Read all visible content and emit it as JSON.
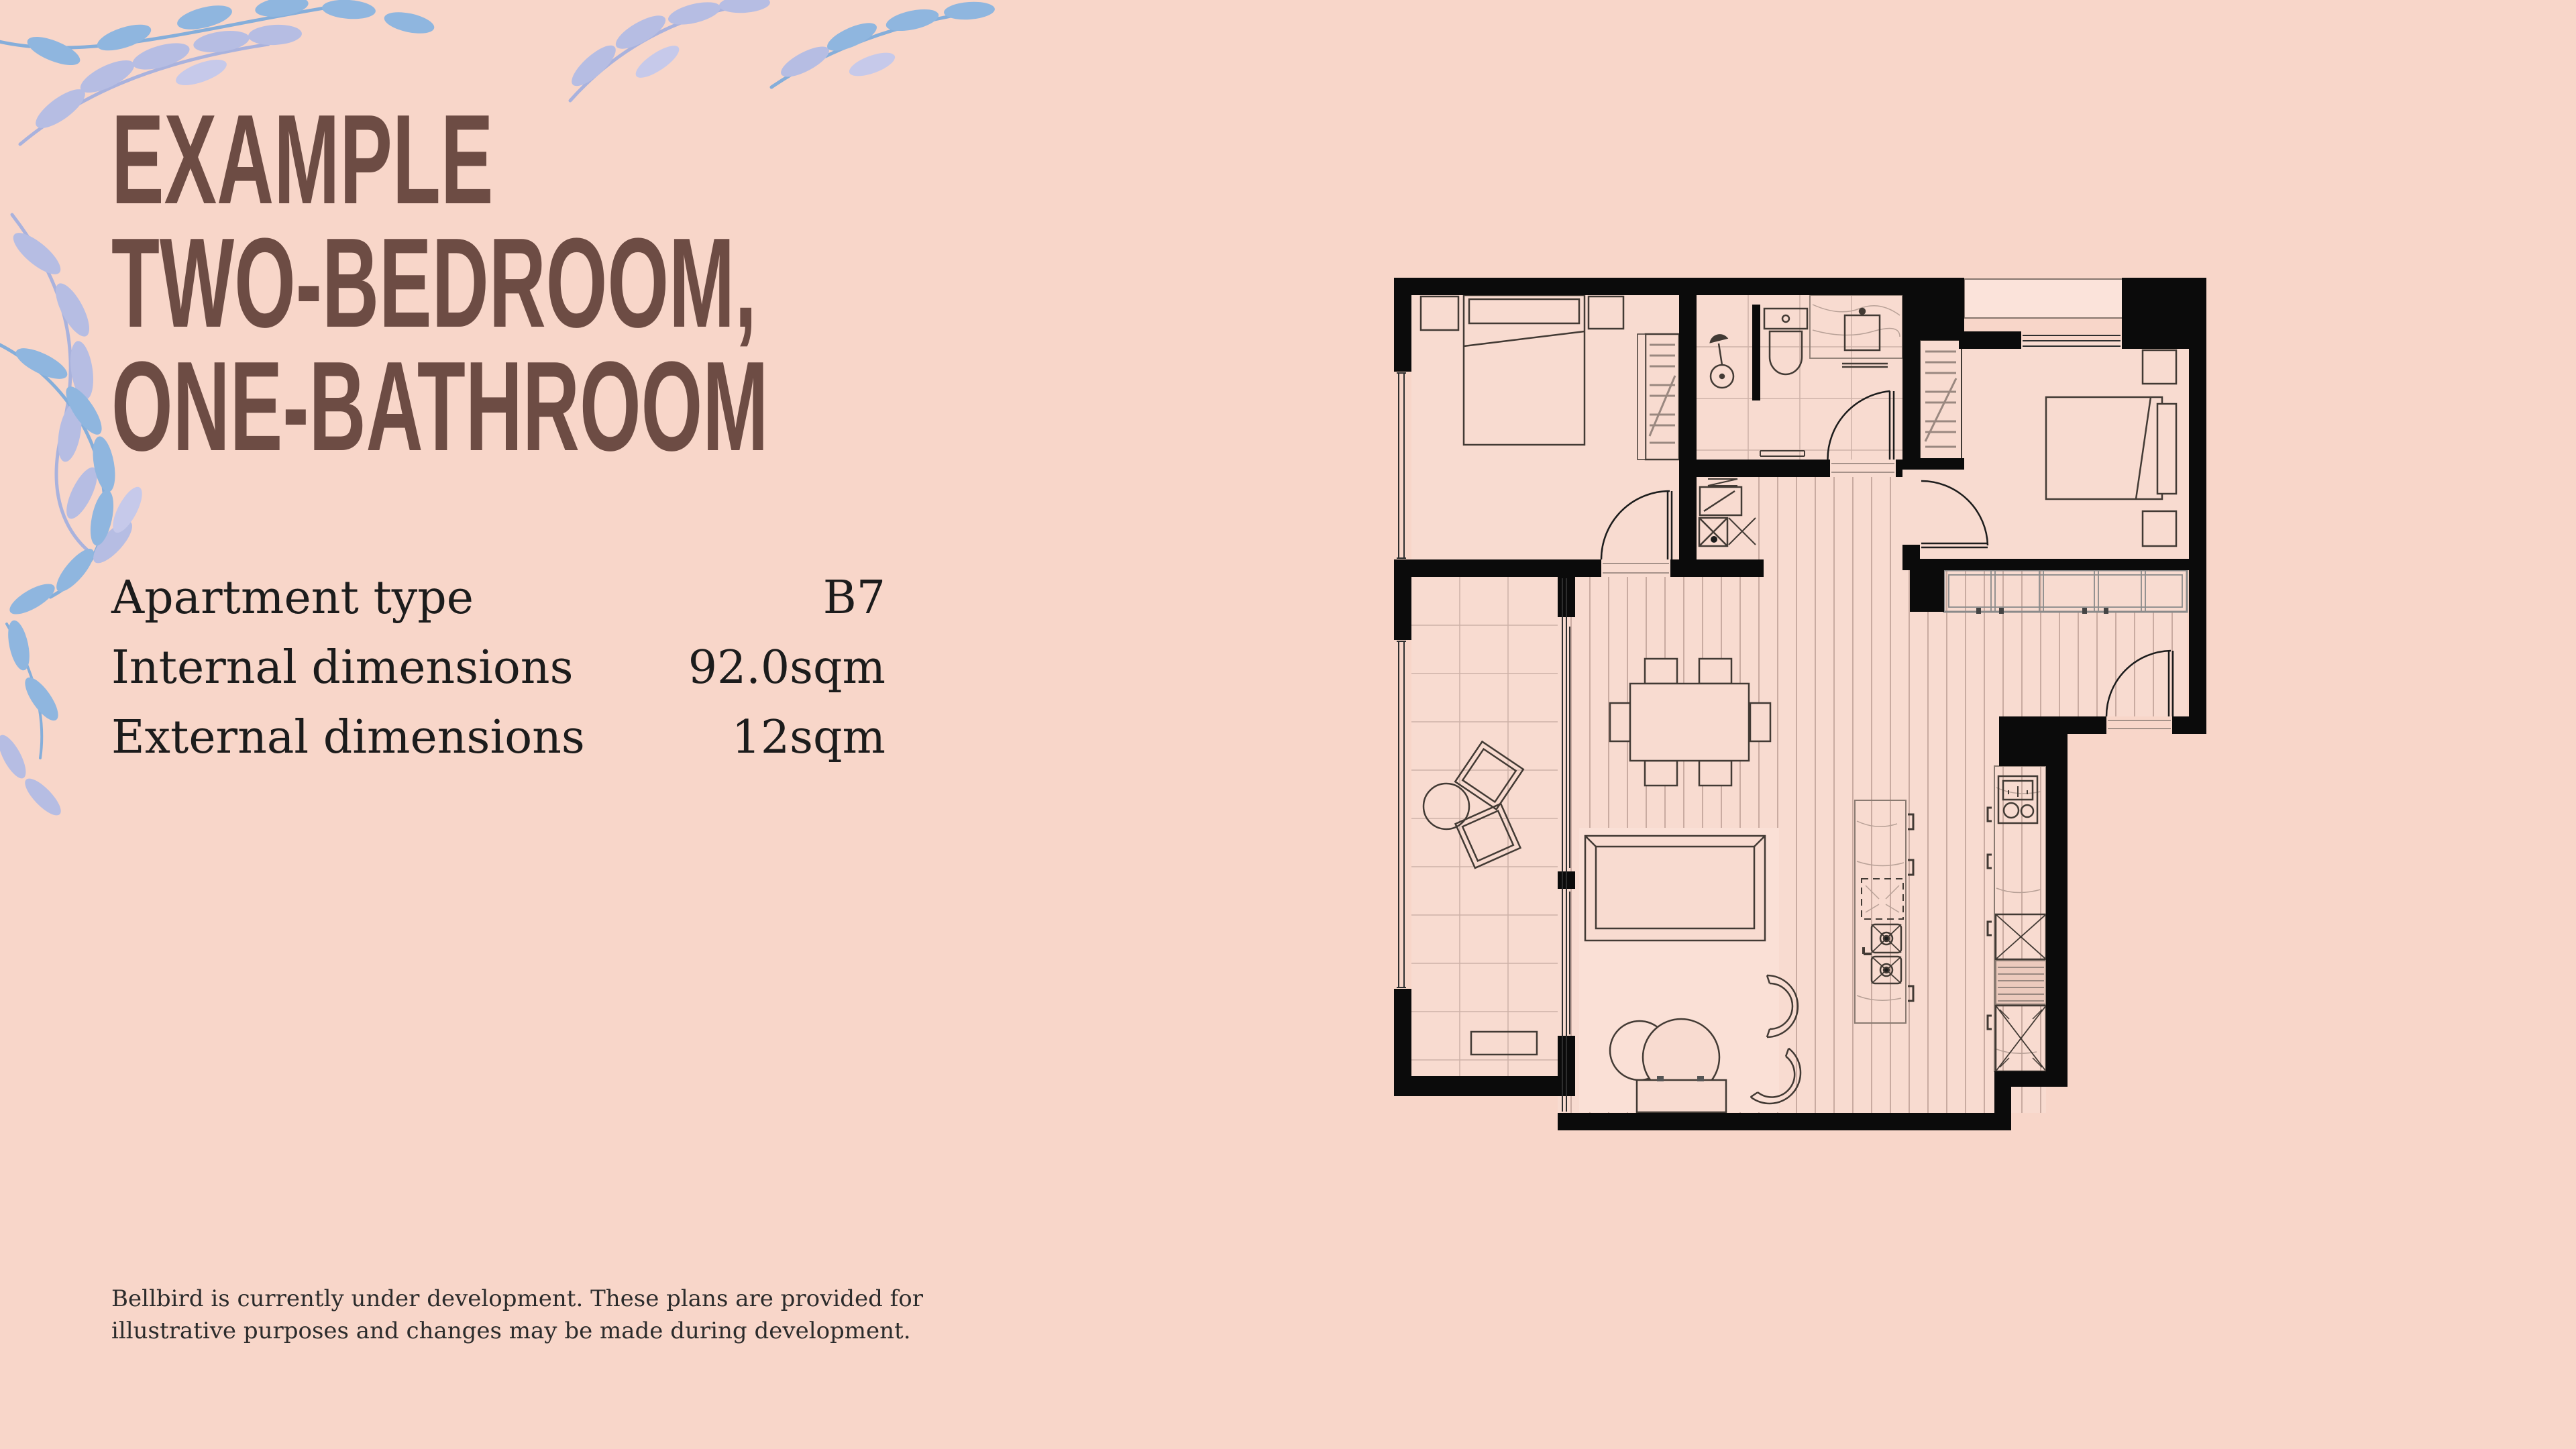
{
  "colors": {
    "background": "#f8d6c9",
    "title_brown": "#6d4c44",
    "text_black": "#1c1c1c",
    "wall_black": "#0b0b0b",
    "floor_fill": "#f8dbd0",
    "leaf_lavender": "#b6bde3",
    "leaf_blue": "#8fb6df"
  },
  "title": {
    "line1": "EXAMPLE",
    "line2": "TWO-BEDROOM,",
    "line3": "ONE-BATHROOM"
  },
  "specs": {
    "rows": [
      {
        "label": "Apartment type",
        "value": "B7"
      },
      {
        "label": "Internal dimensions",
        "value": "92.0sqm"
      },
      {
        "label": "External dimensions",
        "value": "12sqm"
      }
    ]
  },
  "disclaimer": {
    "line1": "Bellbird is currently under development. These plans are provided for",
    "line2": "illustrative purposes and changes may be made during development."
  },
  "floor_plan": {
    "icons": [
      "bed-icon",
      "wardrobe-icon",
      "toilet-icon",
      "shower-icon",
      "vanity-sink-icon",
      "washing-machine-icon",
      "dining-table-icon",
      "sofa-icon",
      "coffee-table-icon",
      "armchair-icon",
      "kitchen-island-icon",
      "double-sink-icon",
      "cooktop-icon",
      "fridge-icon",
      "door-swing-icon",
      "window-icon",
      "balcony-planter-icon",
      "tv-unit-icon"
    ]
  }
}
